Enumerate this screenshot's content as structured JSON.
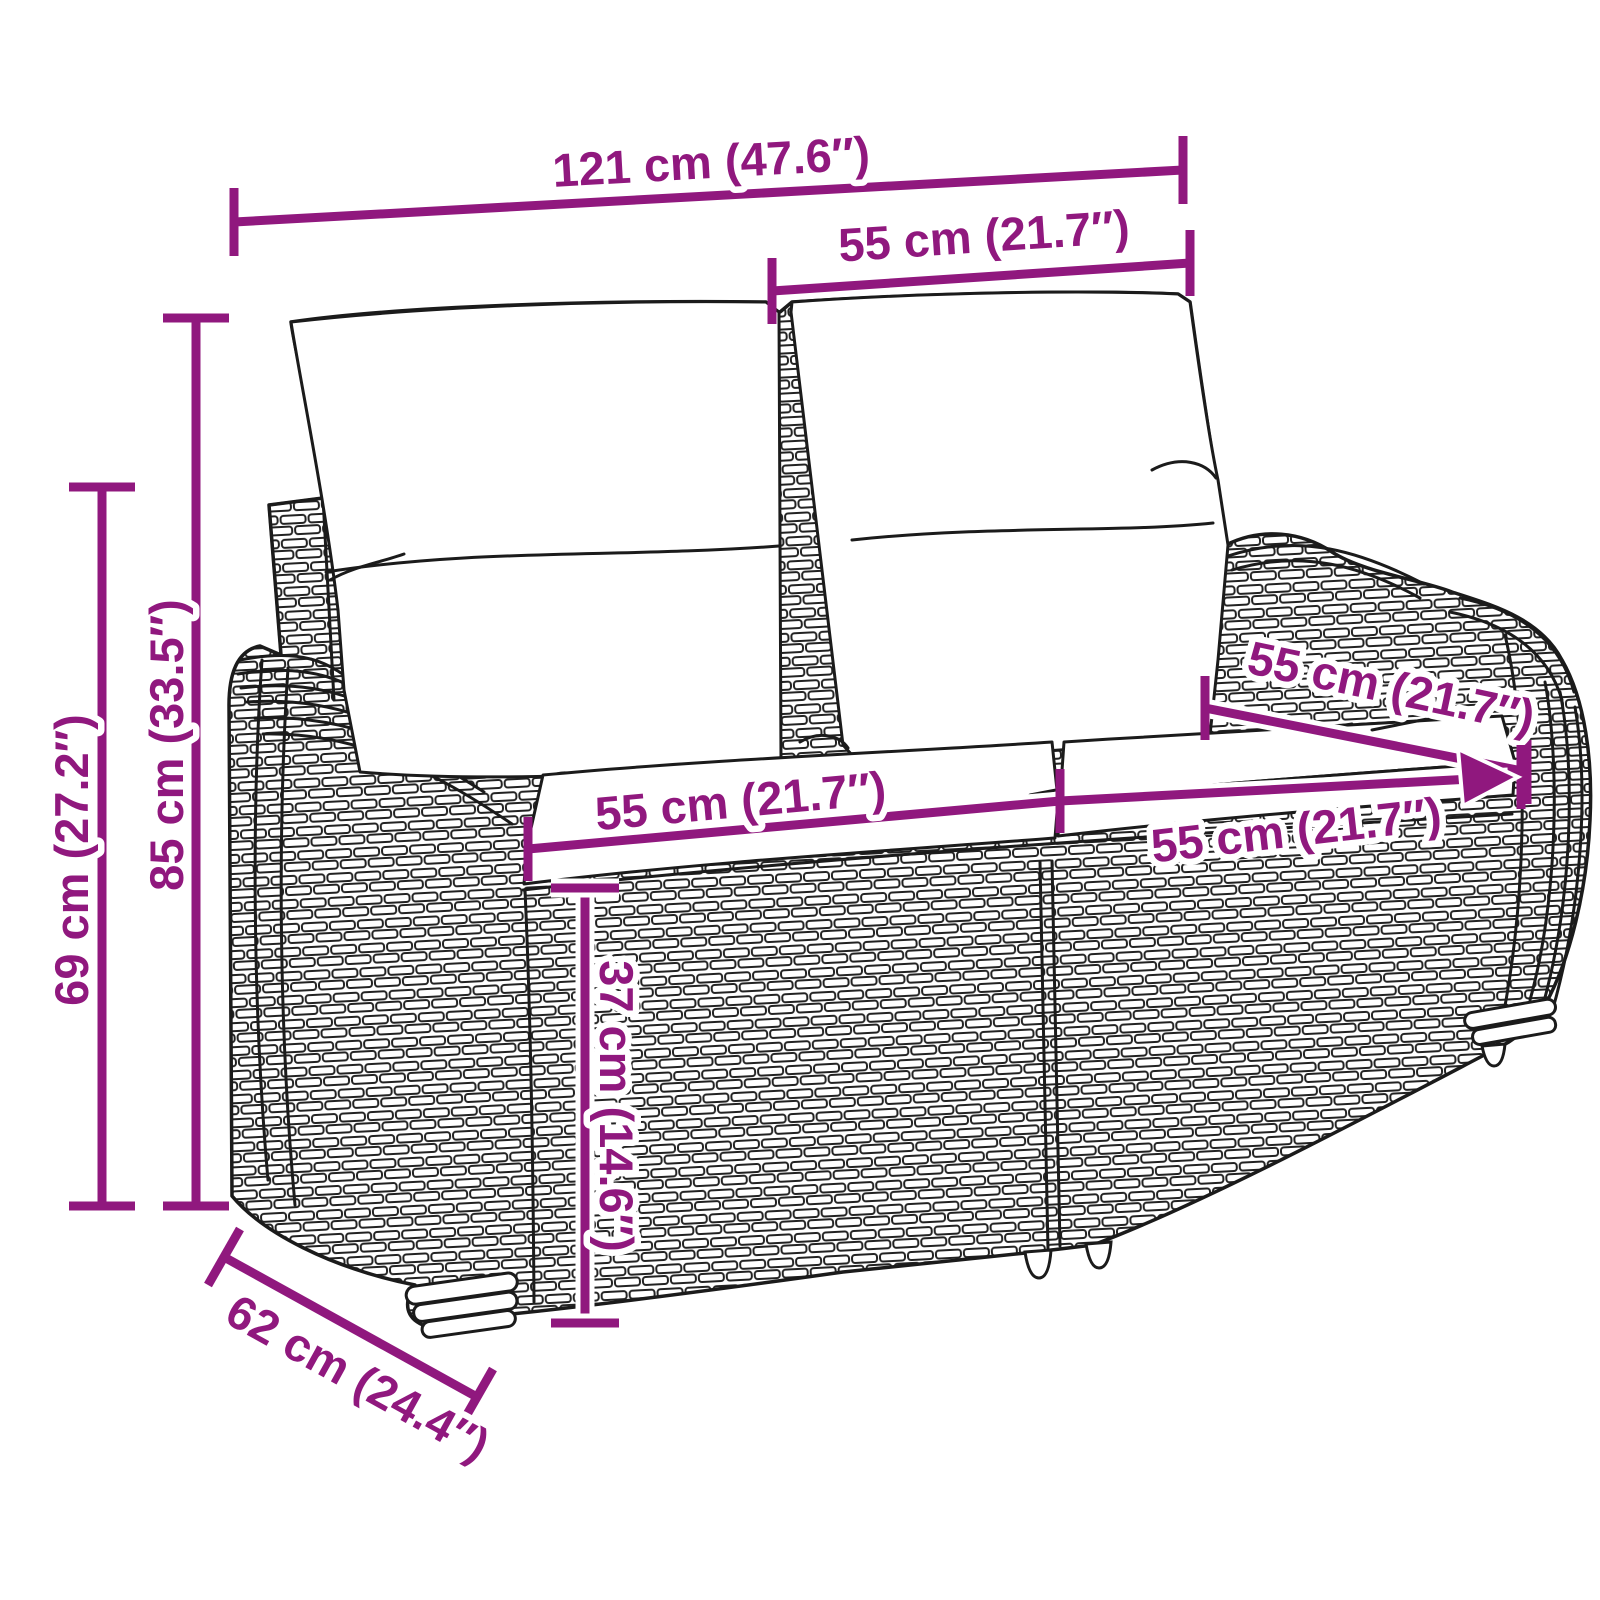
{
  "diagram": {
    "type": "product-dimension-diagram",
    "subject": "poly rattan 2-seater garden bench with back and seat cushions",
    "style": {
      "background": "#ffffff",
      "dimension_color": "#90187E",
      "line_art_color": "#1b1b1b",
      "cushion_fill": "#ffffff"
    },
    "dimensions": {
      "overall_width": {
        "name": "overall width",
        "label": "121 cm (47.6″)"
      },
      "back_cushion_width": {
        "name": "back cushion width",
        "label": "55 cm (21.7″)"
      },
      "total_height": {
        "name": "total height",
        "label": "85 cm (33.5″)"
      },
      "armrest_height": {
        "name": "armrest height",
        "label": "69 cm (27.2″)"
      },
      "seat_depth": {
        "name": "seat depth",
        "label": "55 cm (21.7″)"
      },
      "seat_width_left": {
        "name": "left seat width",
        "label": "55 cm (21.7″)"
      },
      "seat_width_right": {
        "name": "right seat width",
        "label": "55 cm (21.7″)"
      },
      "seat_height": {
        "name": "seat height",
        "label": "37 cm (14.6″)"
      },
      "overall_depth": {
        "name": "overall depth",
        "label": "62 cm (24.4″)"
      }
    }
  }
}
